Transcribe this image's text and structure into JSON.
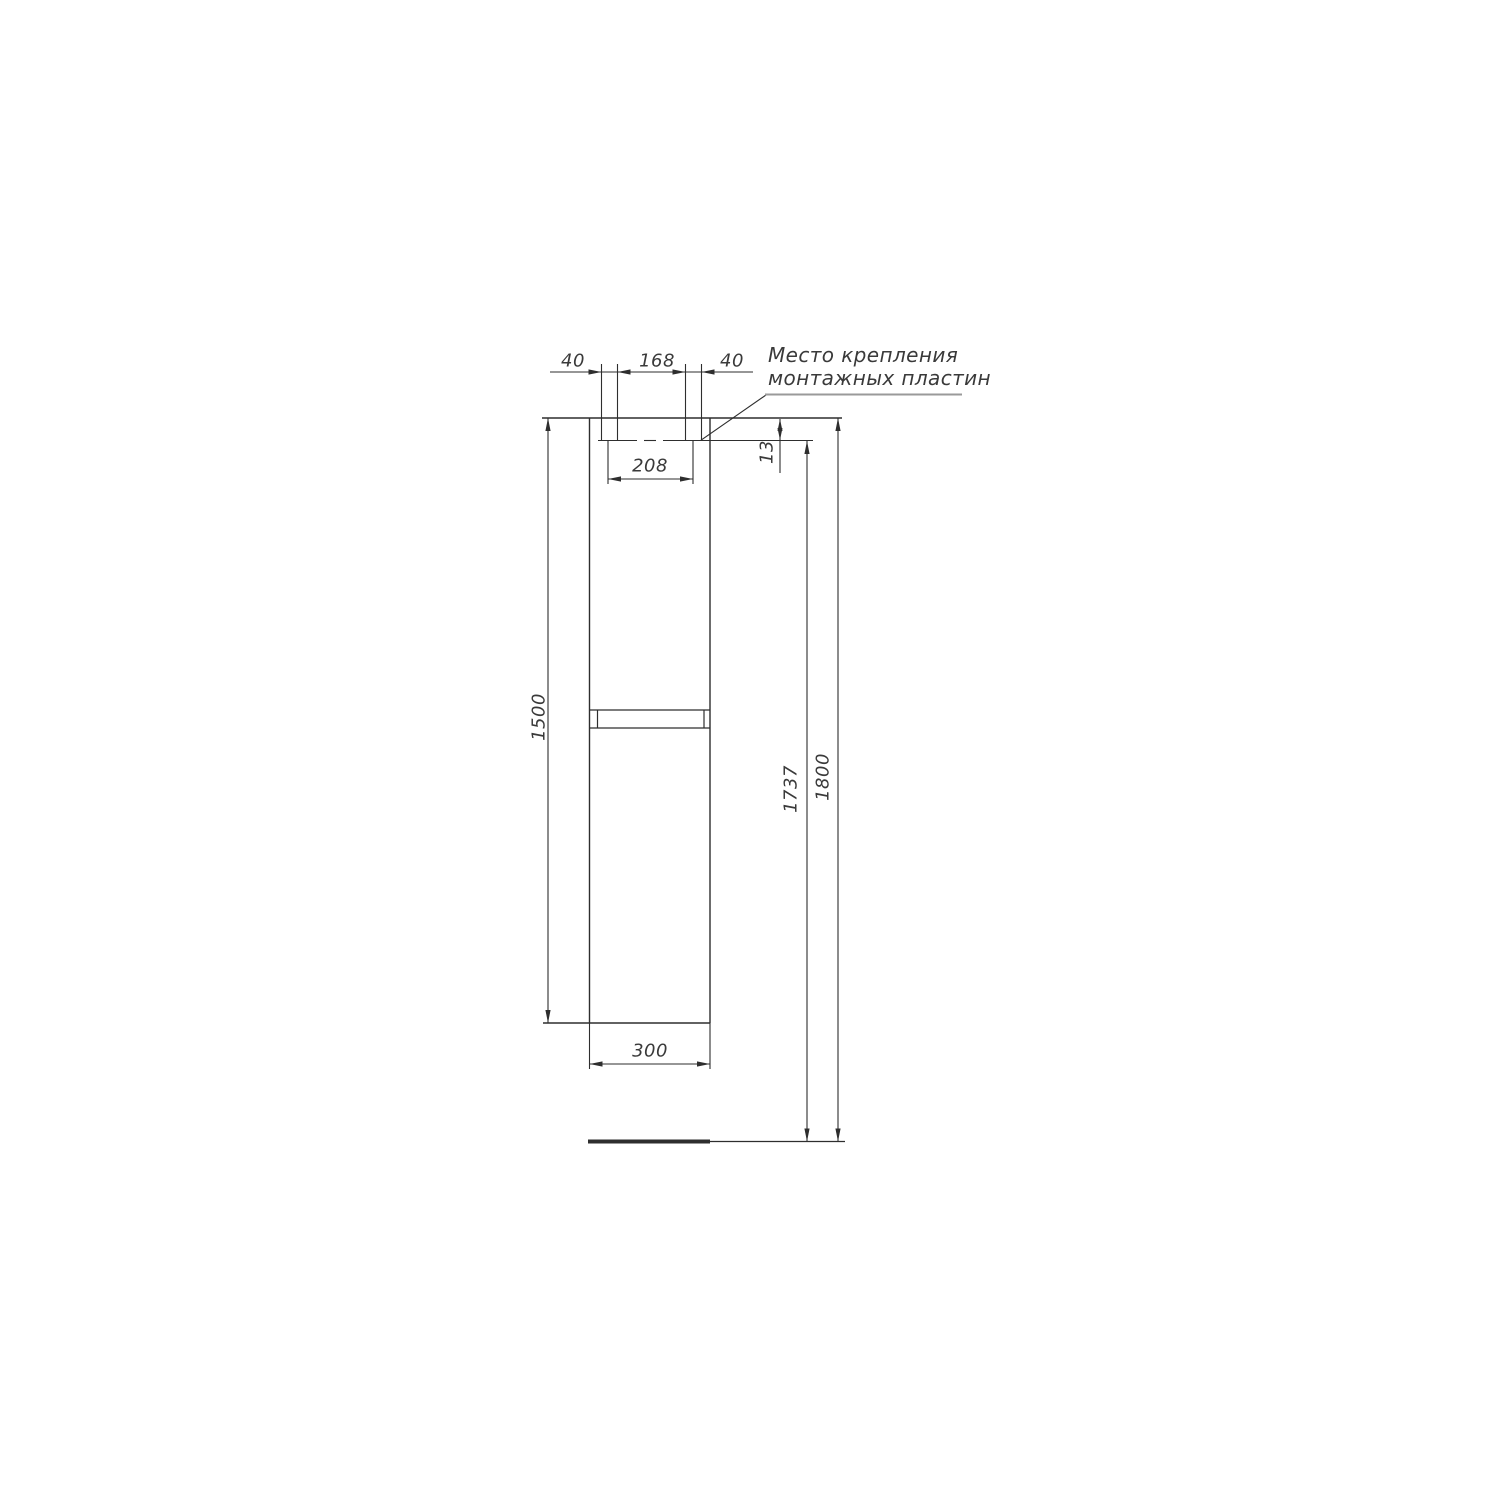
{
  "annotation": {
    "leader_label_line1": "Место крепления",
    "leader_label_line2": "монтажных пластин"
  },
  "dimensions": {
    "plate_left_offset_mm": "40",
    "plate_spacing_mm": "168",
    "plate_right_offset_mm": "40",
    "plate_centers_mm": "208",
    "plate_top_drop_mm": "13",
    "cabinet_height_mm": "1500",
    "plate_height_from_floor_mm": "1737",
    "total_height_mm": "1800",
    "cabinet_width_mm": "300"
  },
  "colors": {
    "background": "#ffffff",
    "line": "#2e2e2e",
    "text": "#3a3a3a",
    "leader_underline": "#9a9a9a"
  }
}
